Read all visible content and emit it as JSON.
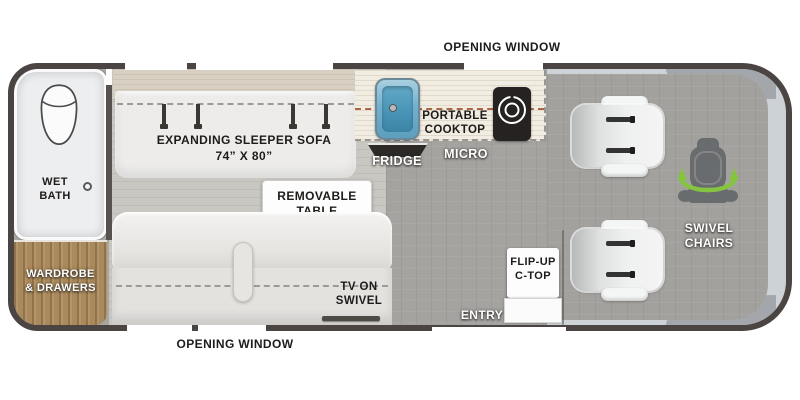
{
  "plan": {
    "top_window_label": "OPENING WINDOW",
    "bottom_window_label": "OPENING WINDOW",
    "wet_bath": {
      "line1": "WET",
      "line2": "BATH"
    },
    "wardrobe": {
      "line1": "WARDROBE",
      "line2": "& DRAWERS"
    },
    "sleeper_sofa": {
      "line1": "EXPANDING SLEEPER SOFA",
      "line2": "74” X 80”"
    },
    "removable_table": {
      "line1": "REMOVABLE",
      "line2": "TABLE"
    },
    "portable_cooktop": {
      "line1": "PORTABLE",
      "line2": "COOKTOP"
    },
    "fridge_label": "FRIDGE",
    "micro_label": "MICRO",
    "tv": {
      "line1": "TV ON",
      "line2": "SWIVEL"
    },
    "entry_label": "ENTRY",
    "flip_up_ctop": {
      "line1": "FLIP-UP",
      "line2": "C-TOP"
    },
    "swivel_chairs": {
      "line1": "SWIVEL",
      "line2": "CHAIRS"
    }
  },
  "icons": [
    "toilet-icon",
    "shower-drain-icon",
    "sink-icon",
    "burner-icon",
    "fridge-icon",
    "seatbelt-icon",
    "tv-icon",
    "swivel-seat-icon",
    "swivel-arrow-icon",
    "armrest-icon",
    "window-segment",
    "entry-opening"
  ],
  "colors": {
    "outline": "#4a4442",
    "floor_plank": "#c9c7c2",
    "floor_gray": "#a5a3a0",
    "cab_silver": "#cdd2d6",
    "wood": "#aa8a5c",
    "counter": "#f2ede3",
    "sink_blue": "#5d9fbe",
    "appliance_black": "#262221",
    "swivel_green": "#85c441"
  }
}
